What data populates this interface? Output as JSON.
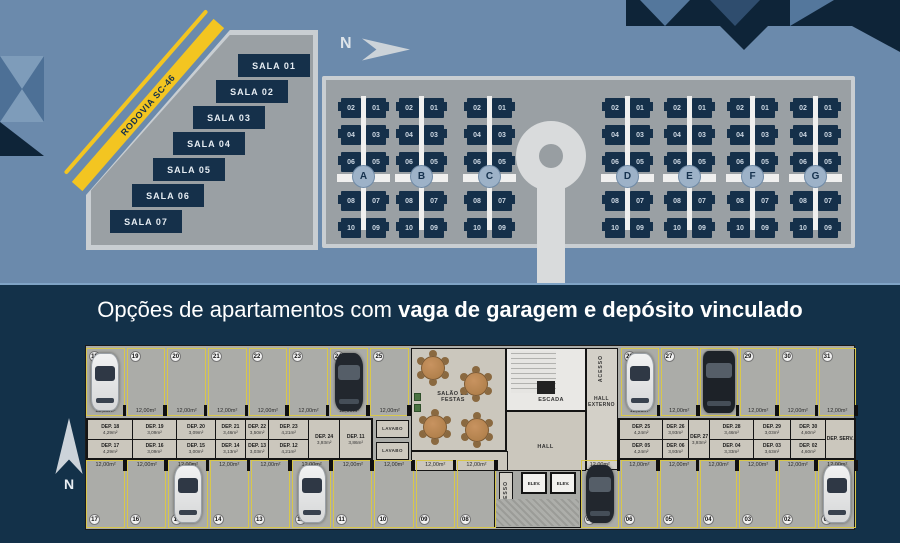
{
  "colors": {
    "background": "#6b8aac",
    "navy": "#15304a",
    "band_navy": "#133149",
    "road_yellow": "#f3c521",
    "site_gray": "#9aa0a4",
    "light_gray": "#d9dbdc",
    "plan_concrete": "#abaca8",
    "stall_outline_yellow": "#d8c74c"
  },
  "site_plan": {
    "north_label": "N",
    "road_label": "RODOVIA SC-46",
    "salas": [
      "SALA 01",
      "SALA 02",
      "SALA 03",
      "SALA 04",
      "SALA 05",
      "SALA 06",
      "SALA 07"
    ],
    "buildings": [
      "A",
      "B",
      "C",
      "D",
      "E",
      "F",
      "G"
    ],
    "unit_rows": [
      [
        "02",
        "01"
      ],
      [
        "04",
        "03"
      ],
      [
        "06",
        "05"
      ],
      [
        "08",
        "07"
      ],
      [
        "10",
        "09"
      ]
    ]
  },
  "title": {
    "normal": "Opções de apartamentos com ",
    "bold": "vaga de garagem e depósito vinculado"
  },
  "floor_plan": {
    "north_label": "N",
    "stall_area_label": "12,00m²",
    "rooms": {
      "party_room": "SALÃO DE FESTAS",
      "stairs": "ESCADA",
      "external_hall": "HALL EXTERNO",
      "hall": "HALL",
      "access": "ACESSO",
      "lavatory": "LAVABO",
      "elevator": "ELEV."
    },
    "parking": {
      "top_left": [
        {
          "number": "18",
          "car": "white"
        },
        {
          "number": "19"
        },
        {
          "number": "20"
        },
        {
          "number": "21"
        },
        {
          "number": "22"
        },
        {
          "number": "23"
        },
        {
          "number": "24",
          "car": "dark"
        },
        {
          "number": "25"
        }
      ],
      "top_right": [
        {
          "number": "26",
          "car": "white"
        },
        {
          "number": "27"
        },
        {
          "number": "28",
          "car": "dark-suv"
        },
        {
          "number": "29"
        },
        {
          "number": "30"
        },
        {
          "number": "31"
        }
      ],
      "bottom_left": [
        {
          "number": "17"
        },
        {
          "number": "16"
        },
        {
          "number": "15",
          "car": "white"
        },
        {
          "number": "14"
        },
        {
          "number": "13"
        },
        {
          "number": "12",
          "car": "white"
        },
        {
          "number": "11"
        },
        {
          "number": "10"
        },
        {
          "number": "09"
        },
        {
          "number": "08"
        }
      ],
      "bottom_right": [
        {
          "number": "07",
          "car": "dark"
        },
        {
          "number": "06"
        },
        {
          "number": "05"
        },
        {
          "number": "04"
        },
        {
          "number": "03"
        },
        {
          "number": "02"
        },
        {
          "number": "01",
          "car": "white"
        }
      ]
    },
    "deposits_left": {
      "columns": [
        {
          "top": {
            "name": "DEP. 18",
            "area": "4,29m²"
          },
          "bottom": {
            "name": "DEP. 17",
            "area": "4,29m²"
          }
        },
        {
          "top": {
            "name": "DEP. 19",
            "area": "3,09m²"
          },
          "bottom": {
            "name": "DEP. 16",
            "area": "3,09m²"
          }
        },
        {
          "top": {
            "name": "DEP. 20",
            "area": "3,09m²"
          },
          "bottom": {
            "name": "DEP. 15",
            "area": "3,00m²"
          }
        },
        {
          "top": {
            "name": "DEP. 21",
            "area": "3,46m²"
          },
          "bottom": {
            "name": "DEP. 14",
            "area": "3,13m²"
          }
        },
        {
          "top": {
            "name": "DEP. 22",
            "area": "3,50m²"
          },
          "bottom": {
            "name": "DEP. 13",
            "area": "3,03m²"
          }
        },
        {
          "top": {
            "name": "DEP. 23",
            "area": "4,21m²"
          },
          "bottom": {
            "name": "DEP. 12",
            "area": "4,21m²"
          }
        },
        {
          "single": {
            "name": "DEP. 24",
            "area": "3,93m²"
          }
        },
        {
          "single": {
            "name": "DEP. 11",
            "area": "3,86m²"
          }
        }
      ]
    },
    "deposits_right": {
      "columns": [
        {
          "top": {
            "name": "DEP. 25",
            "area": "4,24m²"
          },
          "bottom": {
            "name": "DEP. 05",
            "area": "4,24m²"
          }
        },
        {
          "top": {
            "name": "DEP. 26",
            "area": "3,93m²"
          },
          "bottom": {
            "name": "DEP. 06",
            "area": "3,93m²"
          }
        },
        {
          "single": {
            "name": "DEP. 27",
            "area": "3,93m²"
          }
        },
        {
          "top": {
            "name": "DEP. 28",
            "area": "3,46m²"
          },
          "bottom": {
            "name": "DEP. 04",
            "area": "3,33m²"
          }
        },
        {
          "top": {
            "name": "DEP. 29",
            "area": "3,03m²"
          },
          "bottom": {
            "name": "DEP. 03",
            "area": "3,63m²"
          }
        },
        {
          "top": {
            "name": "DEP. 30",
            "area": "4,60m²"
          },
          "bottom": {
            "name": "DEP. 02",
            "area": "4,60m²"
          }
        },
        {
          "single": {
            "name": "DEP. SERV.",
            "area": ""
          }
        }
      ]
    }
  }
}
